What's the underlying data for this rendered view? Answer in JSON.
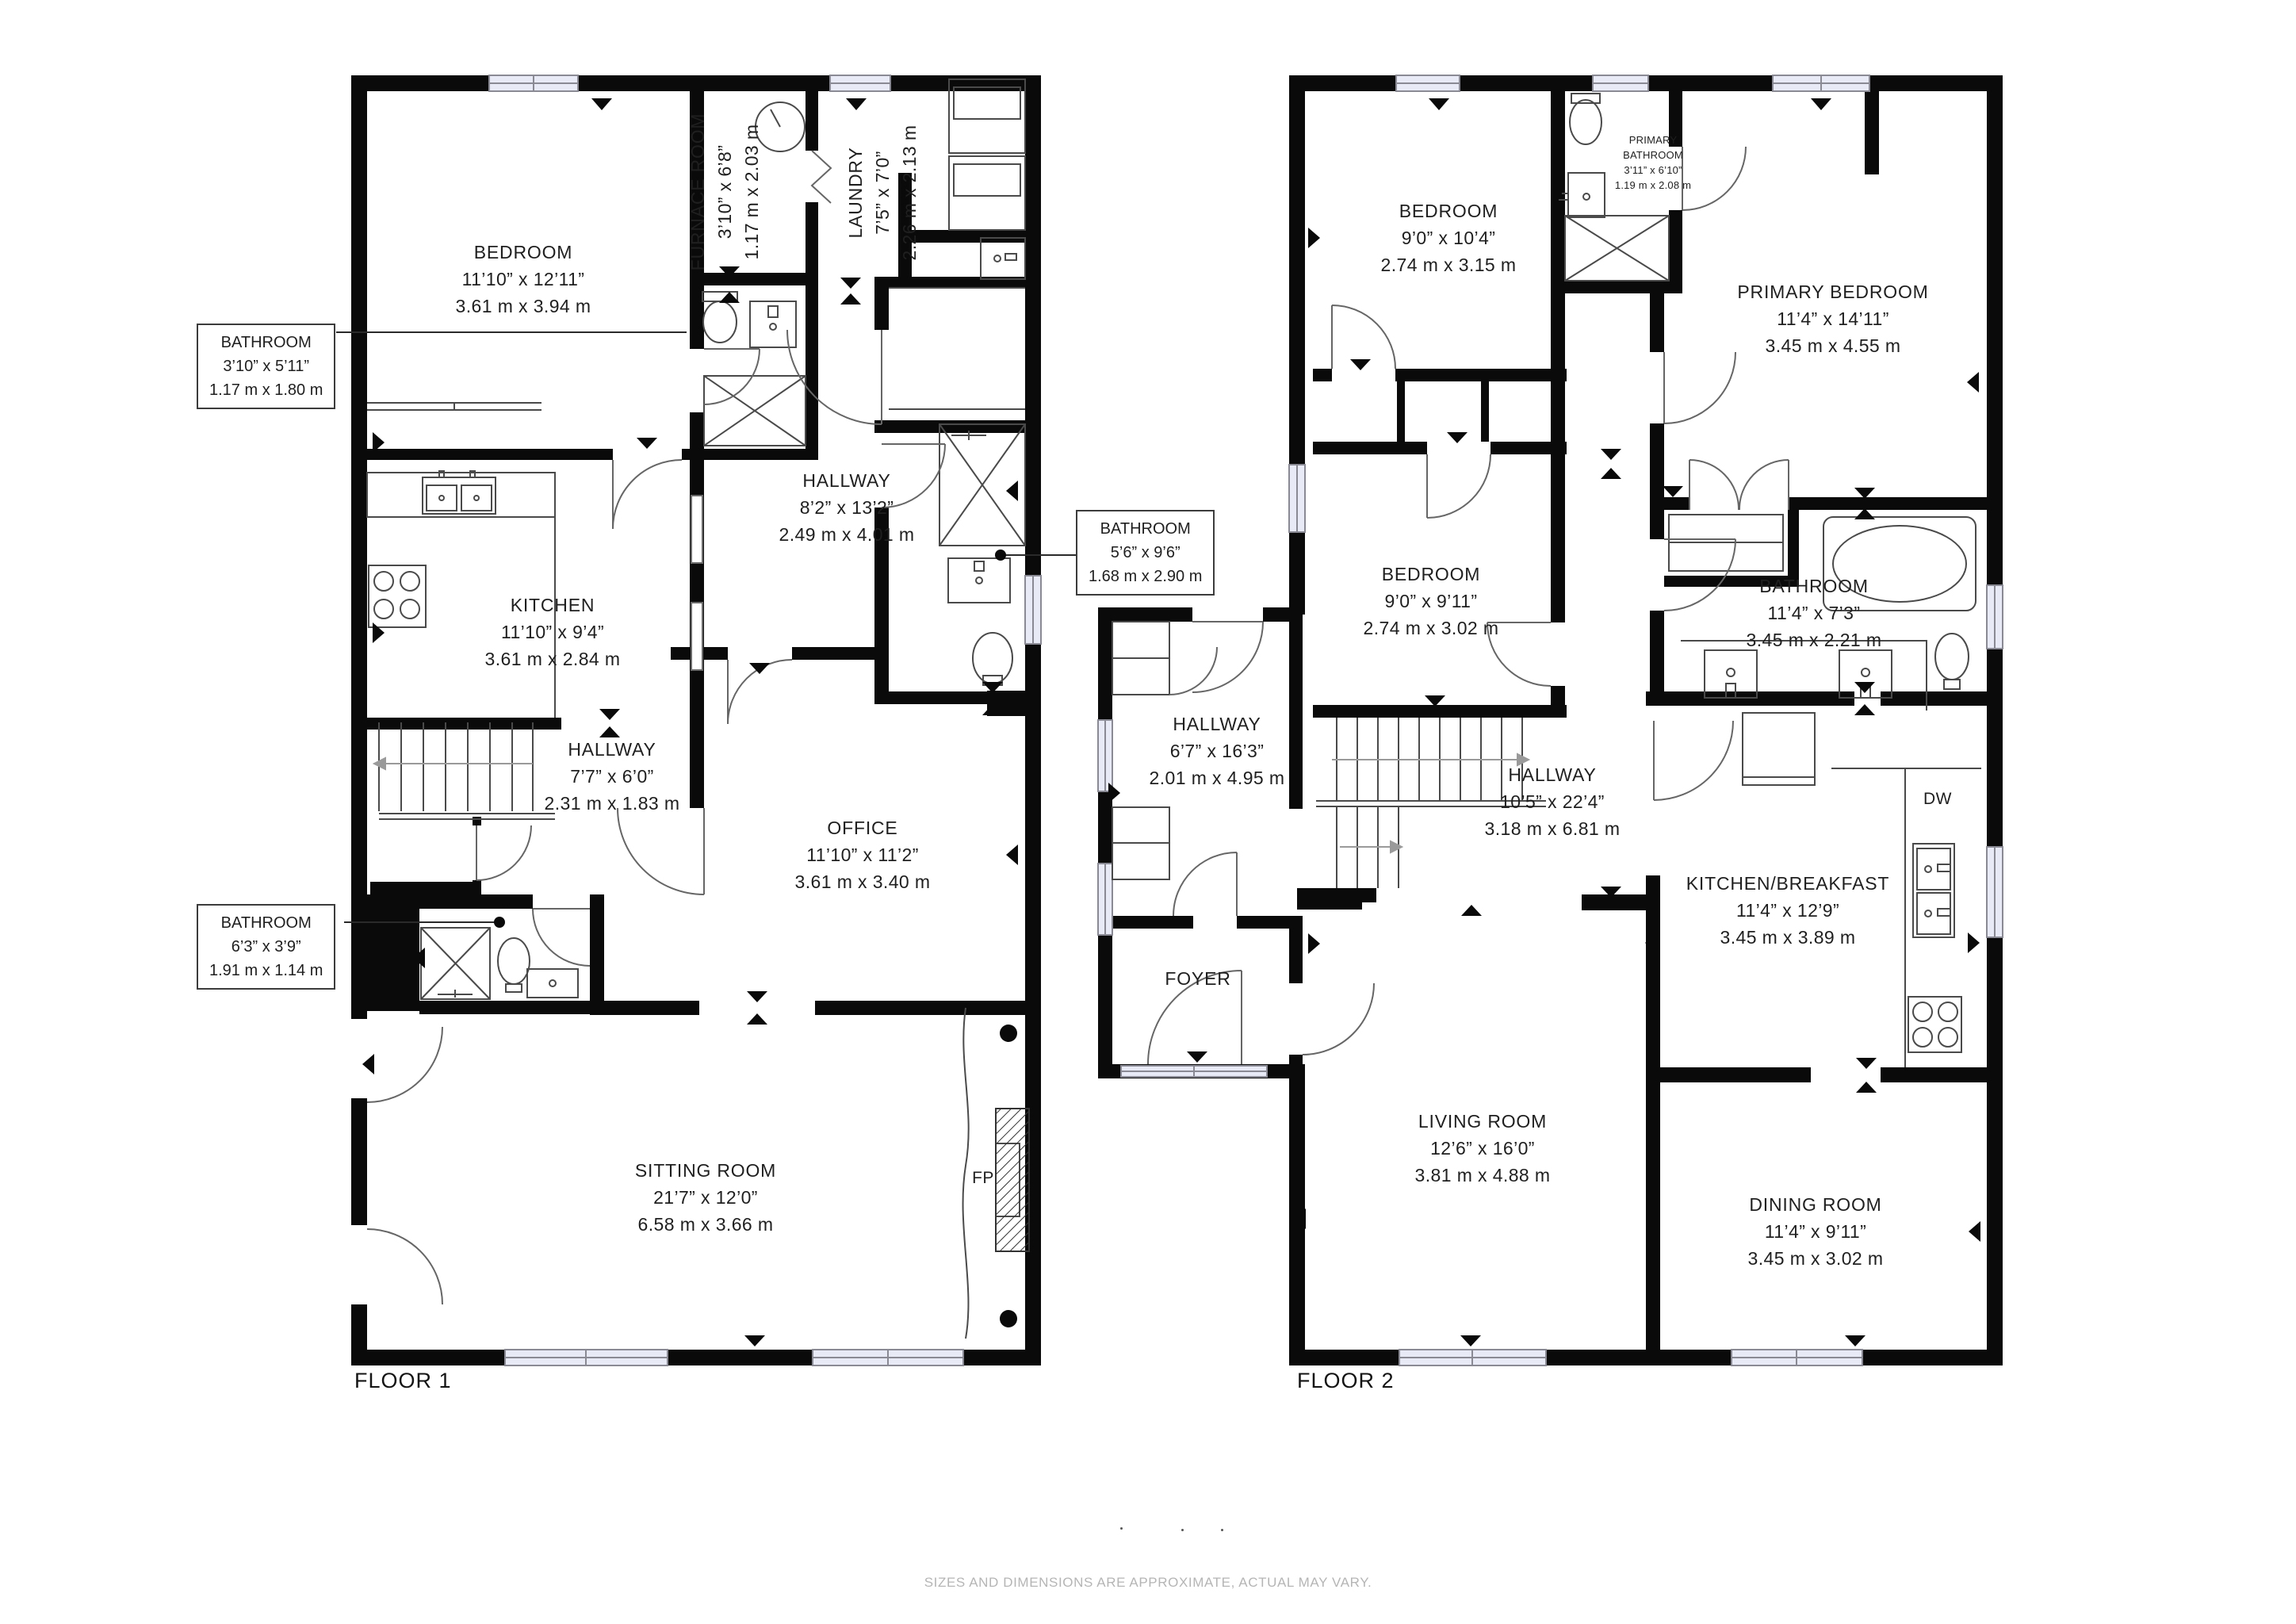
{
  "floor1": {
    "title": "FLOOR 1",
    "rooms": {
      "bedroom": {
        "name": "BEDROOM",
        "imperial": "11’10” x 12’11”",
        "metric": "3.61 m x 3.94 m"
      },
      "furnace_room": {
        "name": "FURNACE ROOM",
        "imperial": "3’10” x 6’8”",
        "metric": "1.17 m x 2.03 m"
      },
      "laundry": {
        "name": "LAUNDRY",
        "imperial": "7’5” x 7’0”",
        "metric": "2.26 m x 2.13 m"
      },
      "hallway_main": {
        "name": "HALLWAY",
        "imperial": "8’2” x 13’2”",
        "metric": "2.49 m x 4.01 m"
      },
      "kitchen": {
        "name": "KITCHEN",
        "imperial": "11’10” x 9’4”",
        "metric": "3.61 m x 2.84 m"
      },
      "hallway_small": {
        "name": "HALLWAY",
        "imperial": "7’7” x 6’0”",
        "metric": "2.31 m x 1.83 m"
      },
      "office": {
        "name": "OFFICE",
        "imperial": "11’10” x 11’2”",
        "metric": "3.61 m x 3.40 m"
      },
      "sitting_room": {
        "name": "SITTING ROOM",
        "imperial": "21’7” x 12’0”",
        "metric": "6.58 m x 3.66 m"
      }
    },
    "callouts": {
      "bathroom_top": {
        "name": "BATHROOM",
        "imperial": "3’10” x 5’11”",
        "metric": "1.17 m x 1.80 m"
      },
      "bathroom_mid": {
        "name": "BATHROOM",
        "imperial": "5’6” x 9’6”",
        "metric": "1.68 m x 2.90 m"
      },
      "bathroom_small": {
        "name": "BATHROOM",
        "imperial": "6’3” x 3’9”",
        "metric": "1.91 m x 1.14 m"
      }
    },
    "fireplace_label": "FP"
  },
  "floor2": {
    "title": "FLOOR 2",
    "rooms": {
      "bedroom_top": {
        "name": "BEDROOM",
        "imperial": "9’0” x 10’4”",
        "metric": "2.74 m x 3.15 m"
      },
      "primary_bathroom": {
        "name_line1": "PRIMARY",
        "name_line2": "BATHROOM",
        "imperial": "3’11” x 6’10”",
        "metric": "1.19 m x 2.08 m"
      },
      "primary_bedroom": {
        "name": "PRIMARY BEDROOM",
        "imperial": "11’4” x 14’11”",
        "metric": "3.45 m x 4.55 m"
      },
      "bedroom_mid": {
        "name": "BEDROOM",
        "imperial": "9’0” x 9’11”",
        "metric": "2.74 m x 3.02 m"
      },
      "bathroom": {
        "name": "BATHROOM",
        "imperial": "11’4” x 7’3”",
        "metric": "3.45 m x 2.21 m"
      },
      "hallway_side": {
        "name": "HALLWAY",
        "imperial": "6’7” x 16’3”",
        "metric": "2.01 m x 4.95 m"
      },
      "hallway_main": {
        "name": "HALLWAY",
        "imperial": "10’5” x 22’4”",
        "metric": "3.18 m x 6.81 m"
      },
      "kitchen": {
        "name": "KITCHEN/BREAKFAST",
        "imperial": "11’4” x 12’9”",
        "metric": "3.45 m x 3.89 m"
      },
      "living_room": {
        "name": "LIVING ROOM",
        "imperial": "12’6” x 16’0”",
        "metric": "3.81 m x 4.88 m"
      },
      "dining_room": {
        "name": "DINING ROOM",
        "imperial": "11’4” x 9’11”",
        "metric": "3.45 m x 3.02 m"
      },
      "foyer": {
        "name": "FOYER"
      }
    },
    "dishwasher_label": "DW"
  },
  "footer": {
    "disclaimer": "SIZES AND DIMENSIONS ARE APPROXIMATE, ACTUAL MAY VARY."
  }
}
